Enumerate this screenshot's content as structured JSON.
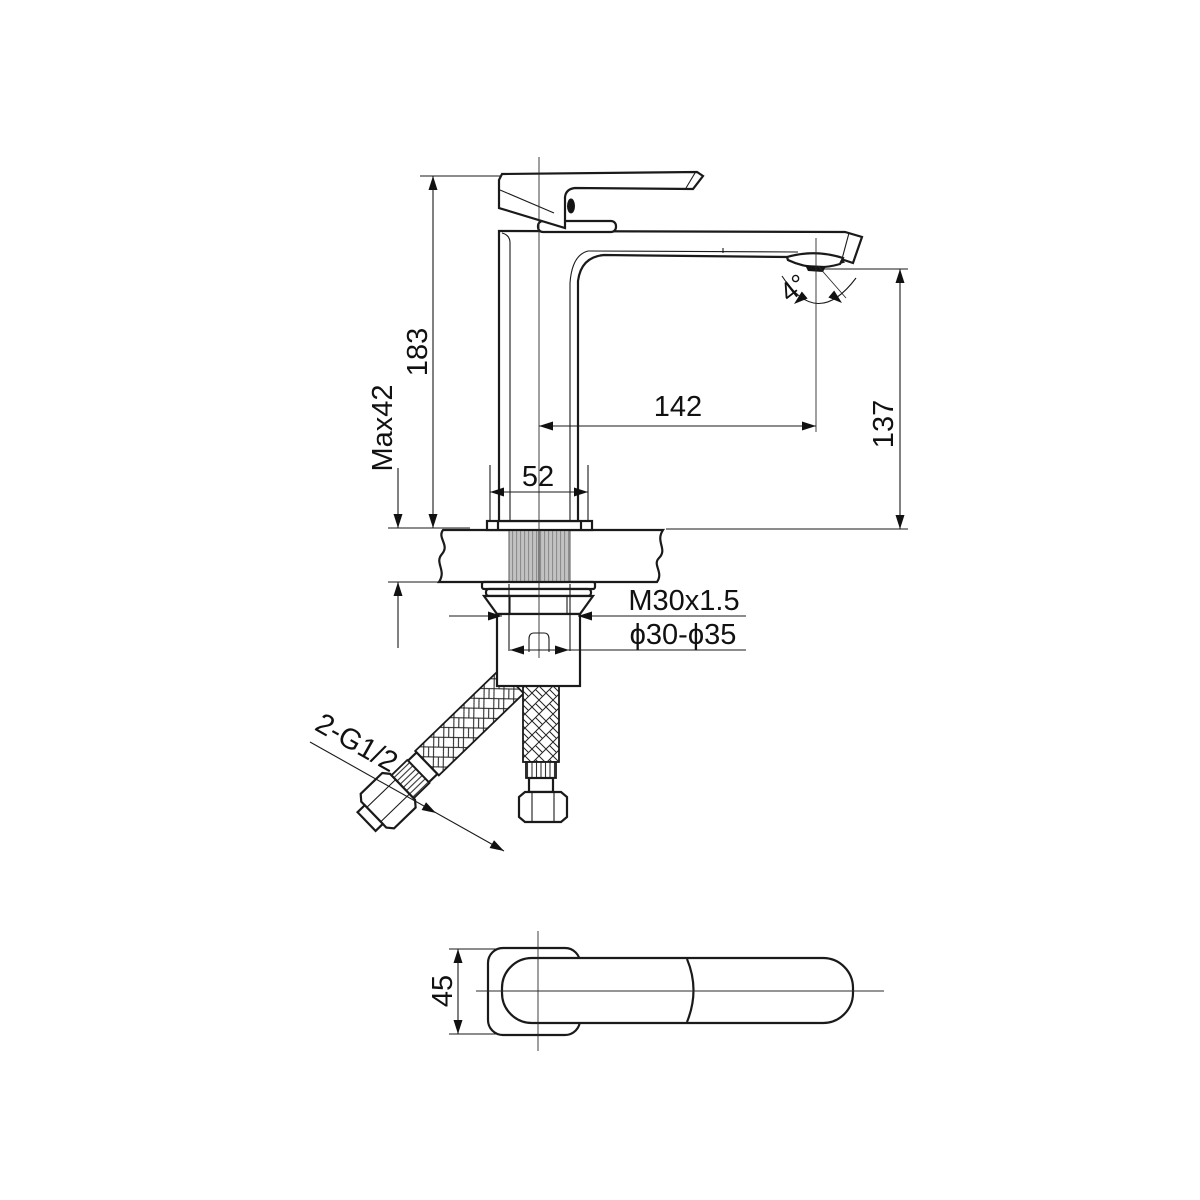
{
  "drawing": {
    "type": "technical-dimension-drawing",
    "subject": "single-lever basin mixer faucet installation drawing",
    "labels": {
      "total_height": "183",
      "counter_thickness": "Max42",
      "spout_reach": "142",
      "outlet_height": "137",
      "base_width": "52",
      "outlet_angle": "4°",
      "shank_thread": "M30x1.5",
      "mounting_hole": "ϕ30-ϕ35",
      "hose_connection": "2-G1/2",
      "handle_width": "45"
    },
    "colors": {
      "line": "#1a1a1a",
      "thread_fill": "#c2c2c2",
      "background": "#ffffff"
    }
  }
}
